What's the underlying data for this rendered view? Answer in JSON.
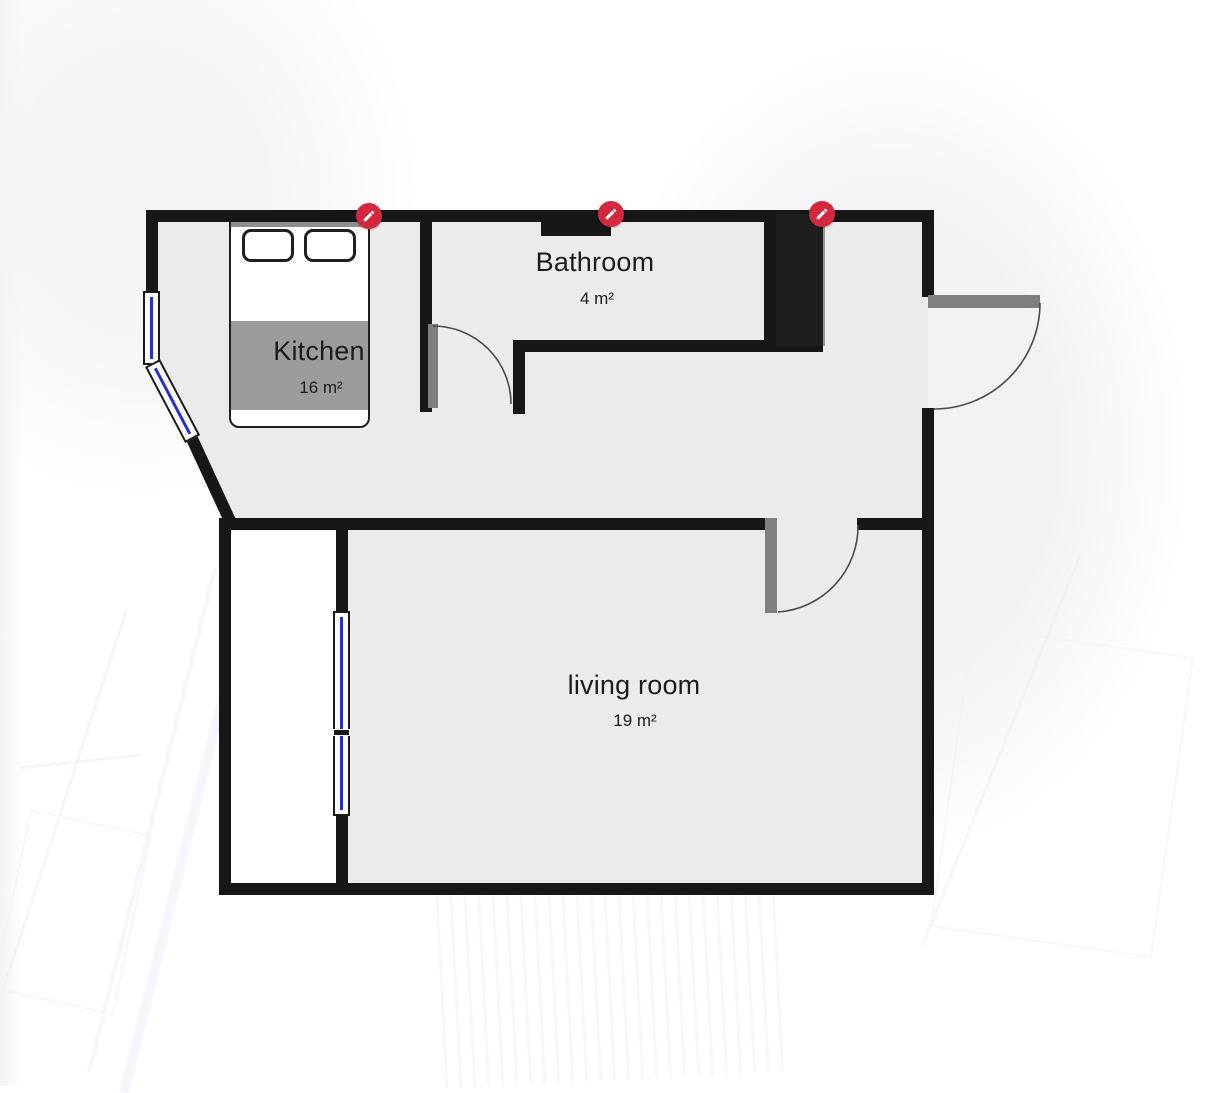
{
  "plan": {
    "rooms": [
      {
        "name": "Kitchen",
        "area": "16 m²"
      },
      {
        "name": "Bathroom",
        "area": "4 m²"
      },
      {
        "name": "living room",
        "area": "19 m²"
      }
    ],
    "pins": [
      {
        "icon": "pencil-icon",
        "attached_to": "bed"
      },
      {
        "icon": "pencil-icon",
        "attached_to": "bathroom-niche"
      },
      {
        "icon": "pencil-icon",
        "attached_to": "shaft"
      }
    ],
    "furniture": [
      {
        "type": "double-bed",
        "room": "Kitchen"
      }
    ],
    "openings": {
      "doors": 3,
      "windows": 3
    },
    "colors": {
      "wall": "#171717",
      "room_fill": "#ebebeb",
      "balcony_fill": "#ffffff",
      "door_leaf": "#7f7f7f",
      "window_glass": "#2230cf",
      "pin_accent": "#d2293e",
      "label_text": "#1c1c1c"
    }
  }
}
